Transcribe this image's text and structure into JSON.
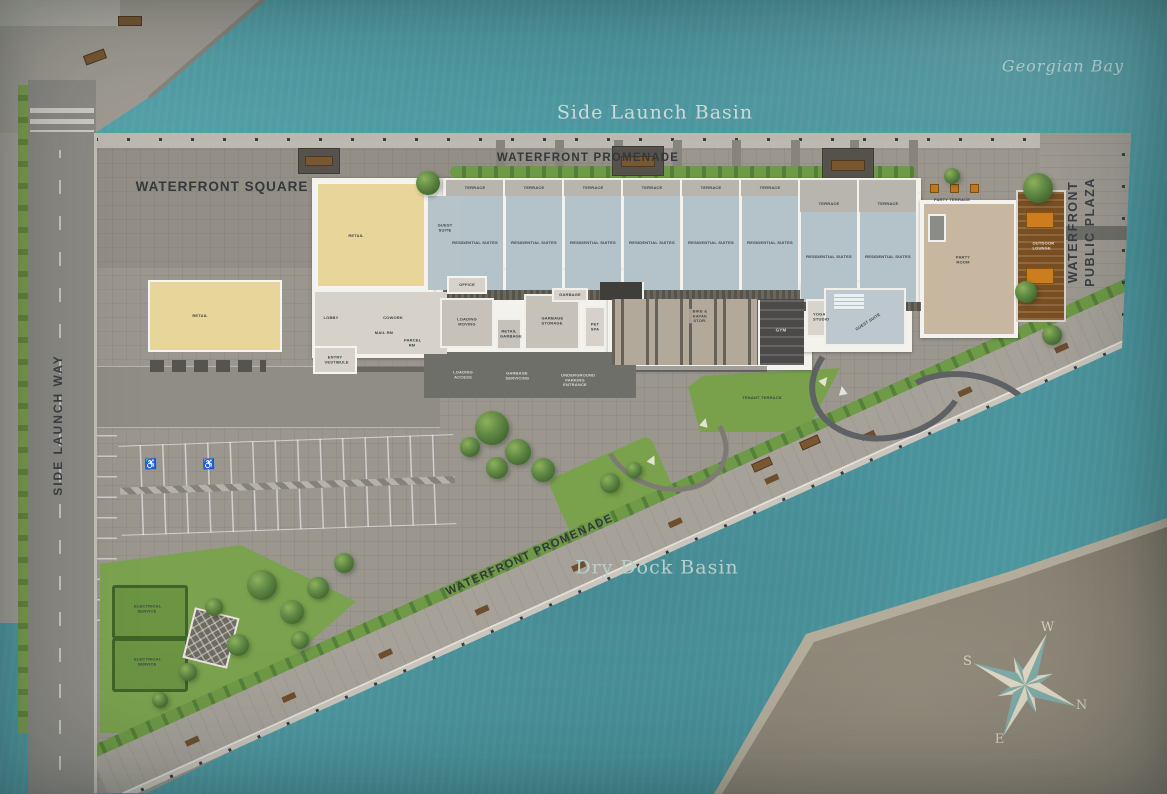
{
  "water": {
    "georgian_bay": "Georgian Bay",
    "side_launch_basin": "Side Launch Basin",
    "dry_dock_basin": "Dry Dock Basin"
  },
  "public_realm": {
    "waterfront_promenade_top": "WATERFRONT PROMENADE",
    "waterfront_promenade_bottom": "WATERFRONT PROMENADE",
    "waterfront_square": "WATERFRONT SQUARE",
    "side_launch_way": "SIDE LAUNCH WAY",
    "waterfront_public_plaza_line1": "WATERFRONT",
    "waterfront_public_plaza_line2": "PUBLIC PLAZA",
    "tenant_terrace": "TENANT TERRACE",
    "party_terrace": "PARTY TERRACE",
    "electrical_service": "ELECTRICAL SERVICE",
    "loading_access": "LOADING ACCESS",
    "garbage_servicing": "GARBAGE SERVICING",
    "underground_parking_entrance": "UNDERGROUND PARKING ENTRANCE"
  },
  "building": {
    "retail": "RETAIL",
    "guest_suite": "GUEST SUITE",
    "residential_suites": "RESIDENTIAL SUITES",
    "terrace": "TERRACE",
    "lobby": "LOBBY",
    "cowork": "COWORK",
    "mail_rm": "MAIL RM",
    "parcel_rm": "PARCEL RM",
    "entry_vestibule": "ENTRY VESTIBULE",
    "office": "OFFICE",
    "loading_moving": "LOADING MOVING",
    "retail_garbage": "RETAIL GARBAGE",
    "garbage_storage": "GARBAGE STORAGE",
    "garbage": "GARBAGE",
    "pet_spa": "PET SPA",
    "bike_kayak_storage": "BIKE & KAYAK STOR.",
    "gym": "GYM",
    "yoga_studio": "YOGA STUDIO",
    "party_room": "PARTY ROOM",
    "outdoor_lounge": "OUTDOOR LOUNGE"
  },
  "compass": {
    "n": "N",
    "e": "E",
    "s": "S",
    "w": "W"
  },
  "colors": {
    "water": "#4E99A2",
    "pavement": "#9B978F",
    "residential": "#B4C2C9",
    "retail": "#E8D59A",
    "lawn": "#7AA24C",
    "wood_deck": "#7A4F22",
    "south_land": "#8A8375",
    "gym_dark": "#4B4A48"
  }
}
